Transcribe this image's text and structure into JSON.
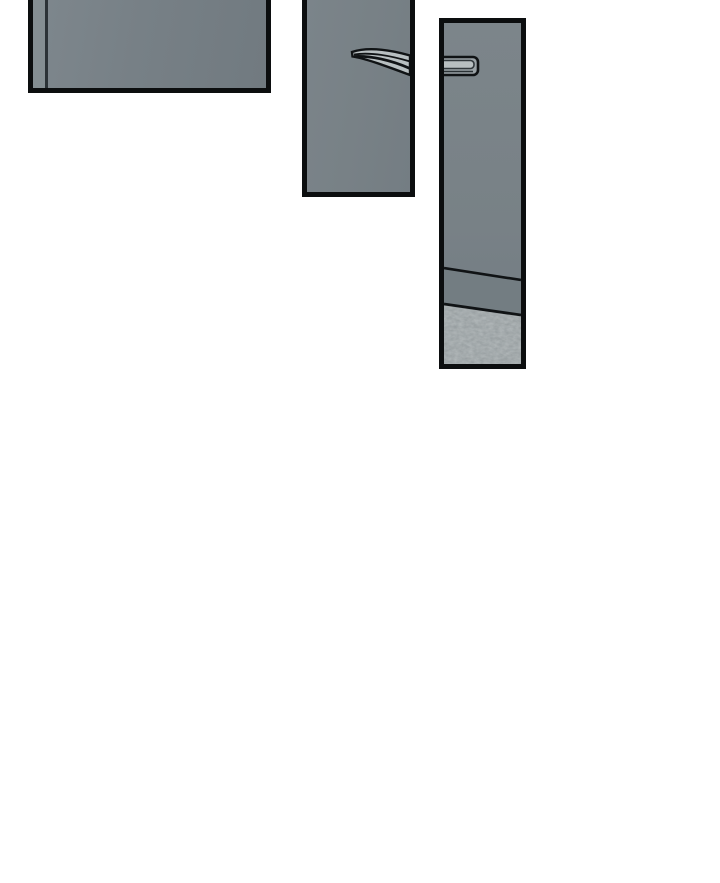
{
  "page": {
    "kind": "comic-strip-excerpt",
    "background": "#ffffff"
  },
  "colors": {
    "page-bg": "#ffffff",
    "panel-border": "#0c0e0f",
    "door-gray": "#788186",
    "door-gray-light": "#848e92",
    "door-seam": "#2b3236",
    "wall-gray": "#737d82",
    "carpet-gray": "#8e9597",
    "carpet-dark": "#5e686d",
    "carpet-light": "#b4bcbd",
    "handle-light": "#b8bfc1",
    "handle-mid": "#9aa2a6",
    "ink": "#101315"
  },
  "panels": [
    {
      "id": "panel-1",
      "description": "Top-left panel, cropped by page top: close-up of a grey door panel with a lighter edge strip and dark vertical seam near its left side."
    },
    {
      "id": "panel-2",
      "description": "Top-middle tall panel, cropped by page top: grey door with a curved metal bar handle extending to the right edge."
    },
    {
      "id": "panel-3",
      "description": "Tall right panel: grey door with a bar handle at upper left, above two skirting lines and a mottled carpeted floor."
    }
  ]
}
